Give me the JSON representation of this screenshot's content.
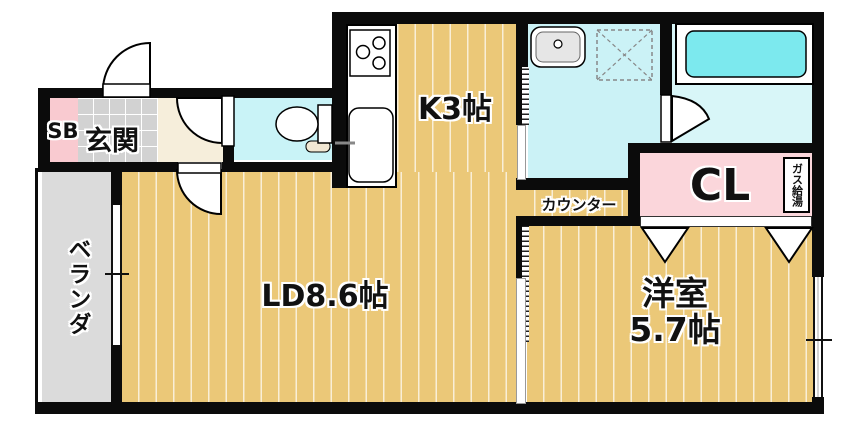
{
  "rooms": {
    "shoe_box": {
      "label": "SB"
    },
    "entrance": {
      "label": "玄関"
    },
    "kitchen": {
      "label": "K3帖"
    },
    "living_dining": {
      "label": "LD8.6帖"
    },
    "western_room": {
      "label": "洋室",
      "size": "5.7帖"
    },
    "closet": {
      "label": "CL"
    },
    "counter": {
      "label": "カウンター"
    },
    "veranda": {
      "label": "ベランダ"
    },
    "gas_water_heater": {
      "label": "ガス給湯"
    }
  },
  "colors": {
    "floor_wood": "#ebc878",
    "floor_stripe": "#f7e6ae",
    "veranda_gray": "#dbdbdb",
    "entrance_tile_gray": "#d2d2d2",
    "closet_pink": "#fbd6db",
    "shoe_box_pink": "#f9cad0",
    "hallway_beige": "#f6eedb",
    "wet_room_cyan": "#cbf2f6",
    "bathtub_cyan": "#7ce9ee",
    "wall_black": "#0b0b0b"
  }
}
